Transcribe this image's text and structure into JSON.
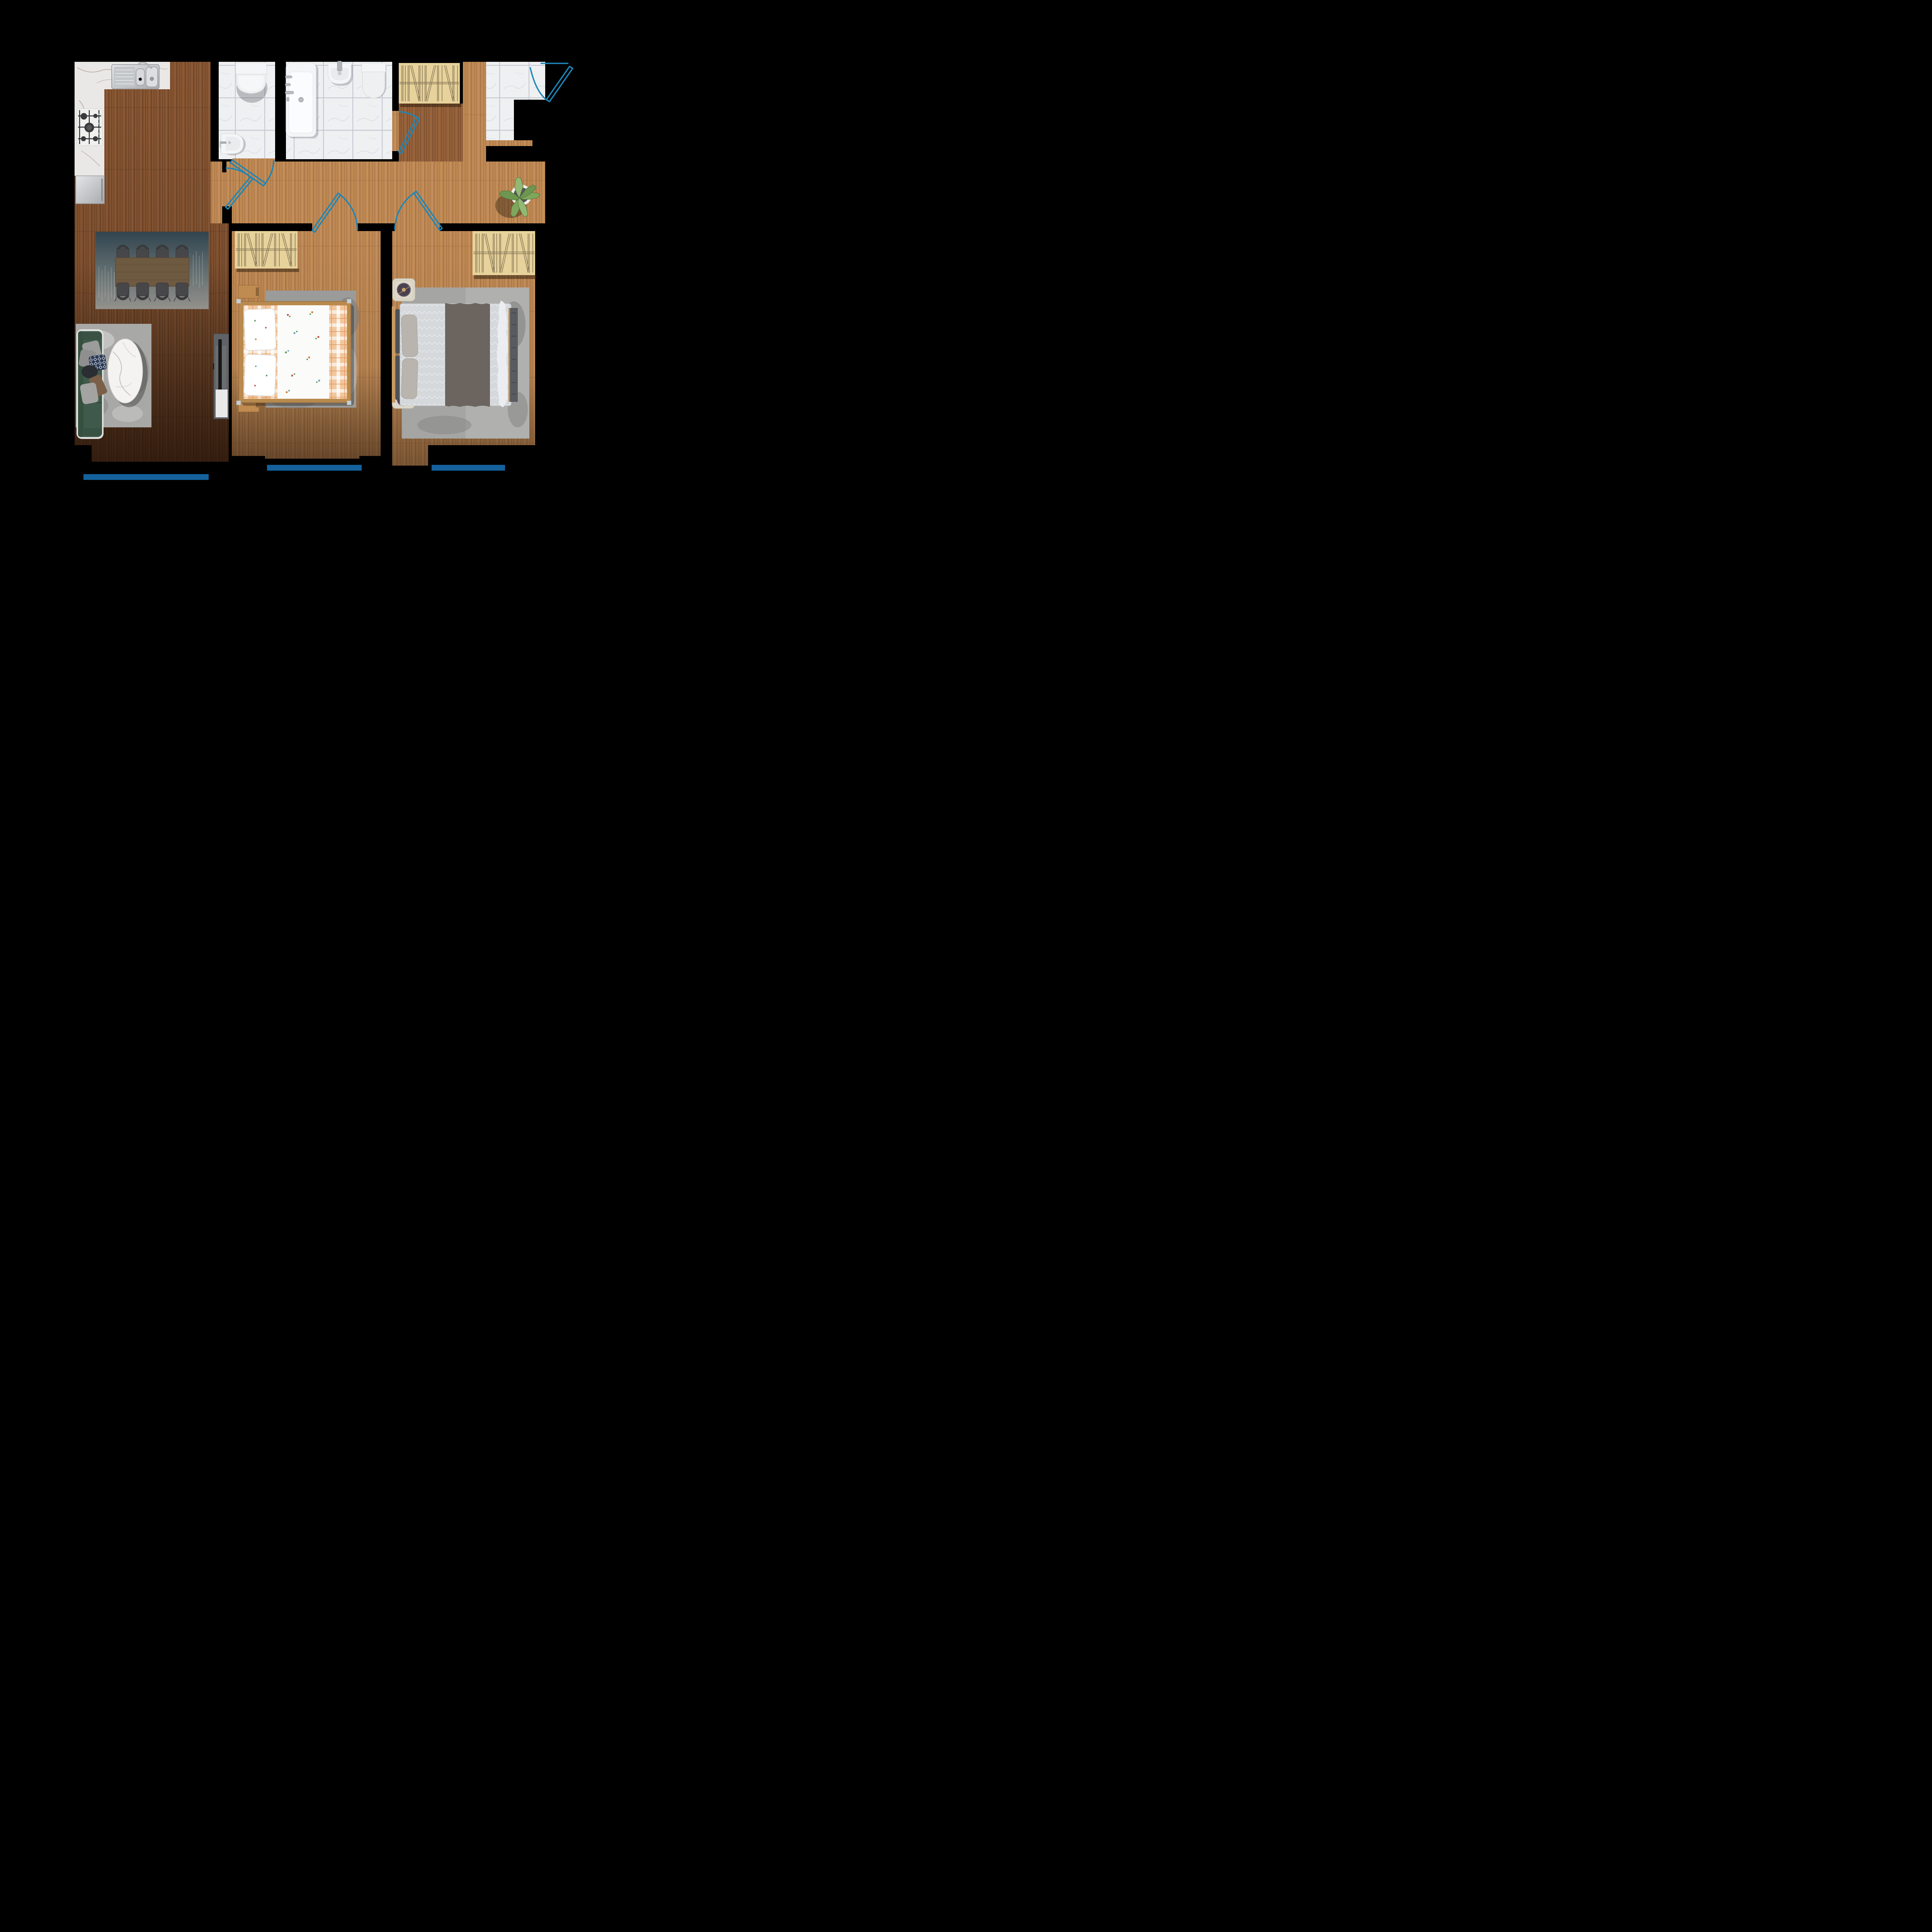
{
  "plan": {
    "kind": "apartment-floor-plan",
    "background": "#000000",
    "counts": {
      "door_swings": 6,
      "balcony_markers": 3,
      "wardrobes": 3,
      "dining_chairs": 8,
      "beds": 2,
      "toilets": 2,
      "nightstands": 4
    },
    "rooms": [
      "kitchen-living-dining",
      "wc",
      "bathroom",
      "hallway",
      "entry",
      "bedroom-1",
      "bedroom-2"
    ]
  },
  "colors": {
    "wall": "#000000",
    "wood_dark": "#8a5733",
    "wood_mid": "#96613a",
    "wood_light": "#c08a55",
    "tile": "#eef0f2",
    "tile_grout": "#c6c8d2",
    "marble_counter": "#eae8e6",
    "steel": "#c6c8ca",
    "appliance": "#c9cbcd",
    "door_swing": "#1d86b8",
    "balcony_marker": "#14619c",
    "wardrobe": "#e7d29b",
    "wardrobe_line": "#6f6046",
    "rug_dining_top": "#31444f",
    "rug_dining_bottom": "#93918c",
    "rug_gray": "#a8a8a6",
    "table_wood": "#6e5a41",
    "chair": "#47474a",
    "sofa_green": "#3f5a4b",
    "pillow_gray": "#9c9c9c",
    "pillow_navy": "#2c3a55",
    "throw_brown": "#7a5f49",
    "coffee_table_marble": "#f4f3f1",
    "tv_unit": "#5f6266",
    "tv_screen": "#17181a",
    "tv_lower": "#e9e9e9",
    "fixture_white": "#f4f5f7",
    "bed1_frame": "#b98a4e",
    "bed1_plaid": "#f2c79e",
    "bed1_sheet": "#fbfbf9",
    "bed2_duvet": "#d6d9dc",
    "bed2_throw": "#6b645f",
    "bed2_pillow": "#b9b5ae",
    "bed2_headboard": "#4e5257",
    "nightstand_wood": "#c08b50",
    "nightstand_cream": "#ddd8ca",
    "nightstand_disc": "#4a4150",
    "plant_leaf": "#7fa75c",
    "plant_pot_center": "#55555a"
  }
}
